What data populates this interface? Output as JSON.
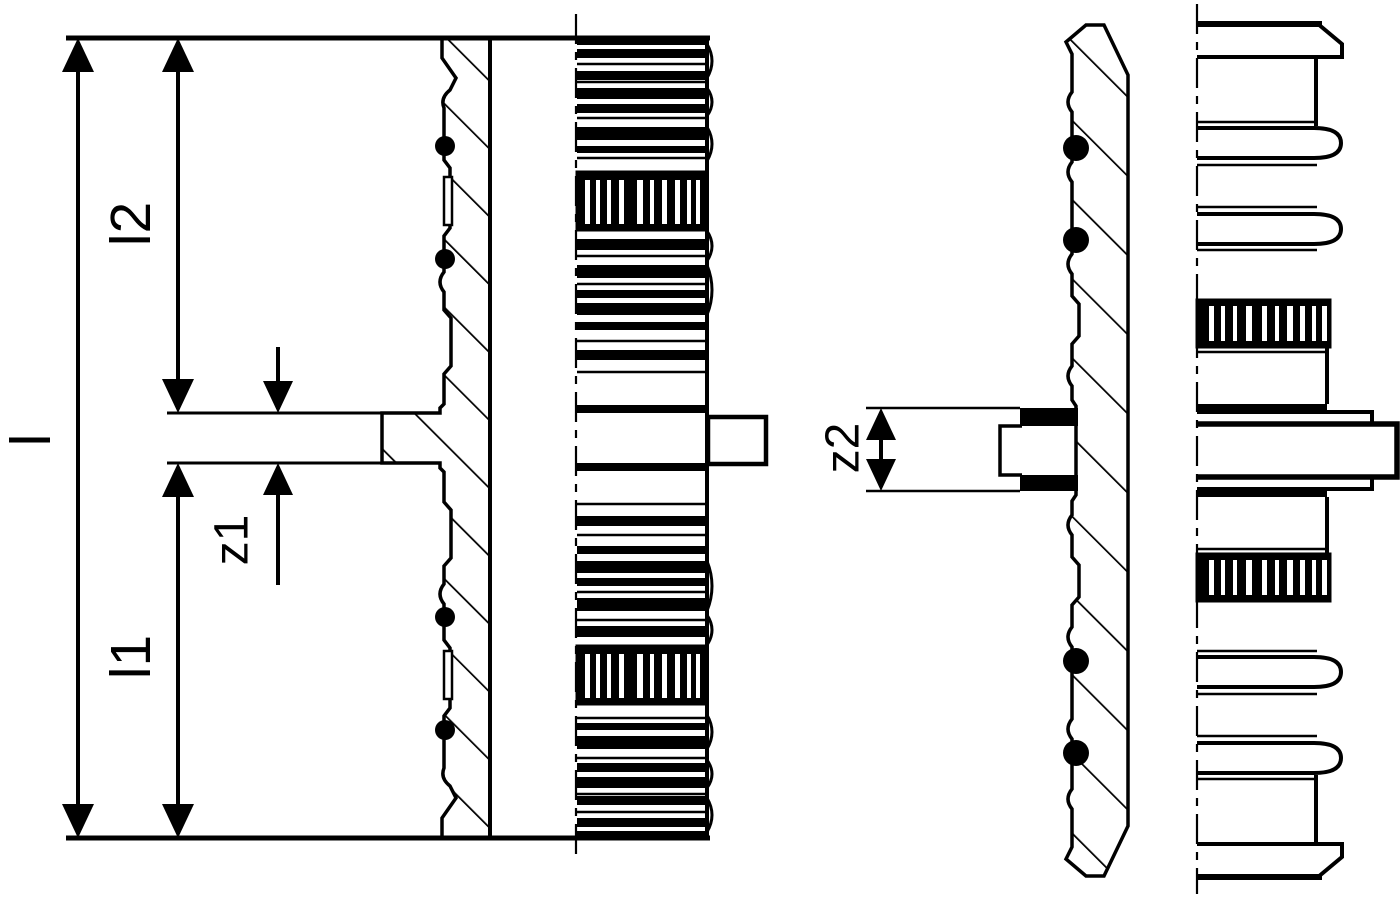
{
  "diagram": {
    "kind": "technical-drawing",
    "labels": {
      "l": "l",
      "l1": "l1",
      "l2": "l2",
      "z1": "z1",
      "z2": "z2"
    },
    "colors": {
      "line": "#000000",
      "background": "#ffffff"
    }
  }
}
